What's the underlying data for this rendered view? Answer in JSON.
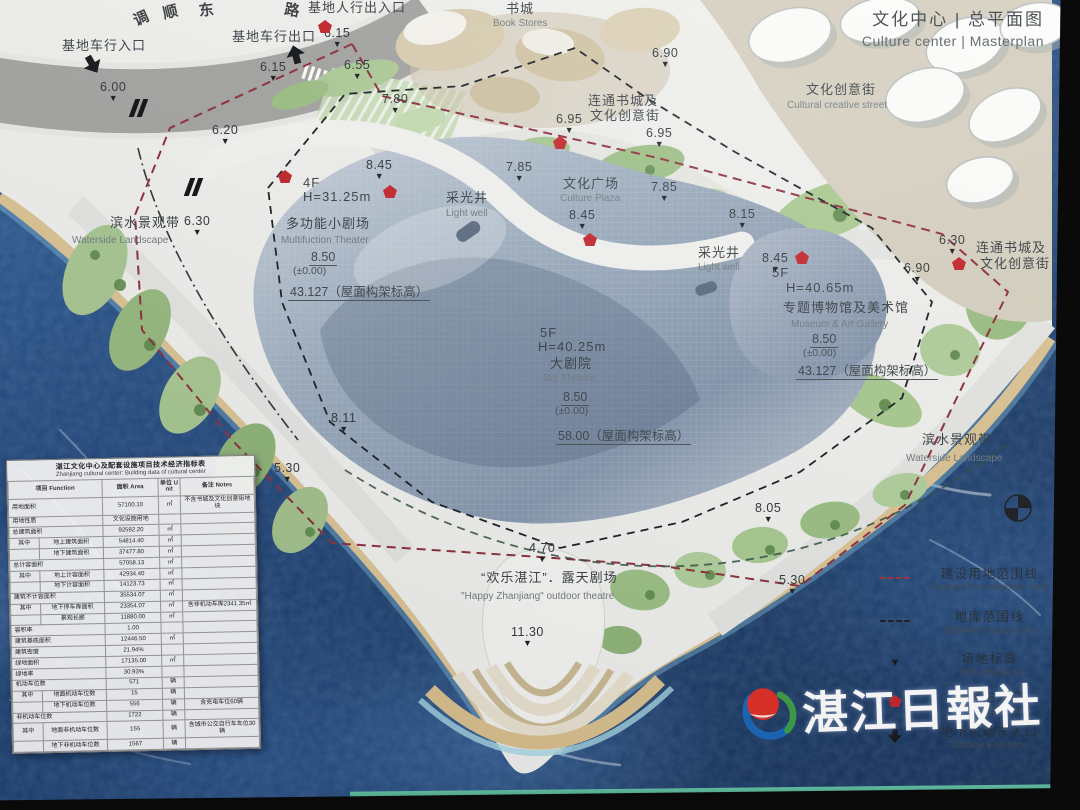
{
  "header": {
    "title_zh": "文化中心 | 总平面图",
    "title_en": "Culture center | Masterplan"
  },
  "logo": {
    "name": "湛江日報社"
  },
  "labels": [
    {
      "t": "调",
      "x": 131,
      "y": 14,
      "cls": "road",
      "rot": -24
    },
    {
      "t": "顺",
      "x": 161,
      "y": 6,
      "cls": "road",
      "rot": -14
    },
    {
      "t": "东",
      "x": 198,
      "y": 3,
      "cls": "road",
      "rot": -6
    },
    {
      "t": "路",
      "x": 286,
      "y": 1,
      "cls": "road",
      "rot": 10
    },
    {
      "t": "基地车行入口",
      "x": 62,
      "y": 39,
      "cls": "zh"
    },
    {
      "t": "基地车行出口",
      "x": 232,
      "y": 30,
      "cls": "zh"
    },
    {
      "t": "基地人行出入口",
      "x": 308,
      "y": 1,
      "cls": "zh"
    },
    {
      "t": "书城",
      "x": 506,
      "y": 2,
      "cls": "zh"
    },
    {
      "t": "Book Stores",
      "x": 493,
      "y": 18,
      "cls": "en"
    },
    {
      "t": "连通书城及",
      "x": 588,
      "y": 94,
      "cls": "zh"
    },
    {
      "t": "文化创意街",
      "x": 590,
      "y": 109,
      "cls": "zh"
    },
    {
      "t": "文化创意街",
      "x": 806,
      "y": 83,
      "cls": "zh"
    },
    {
      "t": "Cultural creative street",
      "x": 787,
      "y": 100,
      "cls": "en"
    },
    {
      "t": "滨水景观带",
      "x": 110,
      "y": 216,
      "cls": "zh"
    },
    {
      "t": "Waterside Landscape",
      "x": 72,
      "y": 235,
      "cls": "en"
    },
    {
      "t": "4F",
      "x": 303,
      "y": 176,
      "cls": "zh"
    },
    {
      "t": "H=31.25m",
      "x": 303,
      "y": 190,
      "cls": "zh"
    },
    {
      "t": "多功能小剧场",
      "x": 286,
      "y": 217,
      "cls": "zh"
    },
    {
      "t": "Multifuction Theater",
      "x": 281,
      "y": 235,
      "cls": "en"
    },
    {
      "t": "8.50",
      "x": 309,
      "y": 250,
      "cls": "val"
    },
    {
      "t": "(±0.00)",
      "x": 293,
      "y": 265,
      "cls": "zhs"
    },
    {
      "t": "43.127（屋面构架标高）",
      "x": 288,
      "y": 285,
      "cls": "val"
    },
    {
      "t": "采光井",
      "x": 446,
      "y": 191,
      "cls": "zh"
    },
    {
      "t": "Light well",
      "x": 446,
      "y": 208,
      "cls": "en"
    },
    {
      "t": "文化广场",
      "x": 563,
      "y": 177,
      "cls": "zh"
    },
    {
      "t": "Culture Plaza",
      "x": 560,
      "y": 193,
      "cls": "en"
    },
    {
      "t": "采光井",
      "x": 698,
      "y": 246,
      "cls": "zh"
    },
    {
      "t": "Light well",
      "x": 698,
      "y": 262,
      "cls": "en"
    },
    {
      "t": "5F",
      "x": 540,
      "y": 326,
      "cls": "zh"
    },
    {
      "t": "H=40.25m",
      "x": 538,
      "y": 340,
      "cls": "zh"
    },
    {
      "t": "大剧院",
      "x": 550,
      "y": 357,
      "cls": "zh"
    },
    {
      "t": "Big Theatre",
      "x": 544,
      "y": 373,
      "cls": "en"
    },
    {
      "t": "8.50",
      "x": 561,
      "y": 390,
      "cls": "val"
    },
    {
      "t": "(±0.00)",
      "x": 555,
      "y": 405,
      "cls": "zhs"
    },
    {
      "t": "58.00（屋面构架标高）",
      "x": 556,
      "y": 429,
      "cls": "val"
    },
    {
      "t": "5F",
      "x": 772,
      "y": 266,
      "cls": "zh"
    },
    {
      "t": "H=40.65m",
      "x": 786,
      "y": 281,
      "cls": "zh"
    },
    {
      "t": "专题博物馆及美术馆",
      "x": 783,
      "y": 301,
      "cls": "zh"
    },
    {
      "t": "Museum & Art Gallery",
      "x": 791,
      "y": 319,
      "cls": "en"
    },
    {
      "t": "8.50",
      "x": 810,
      "y": 332,
      "cls": "val"
    },
    {
      "t": "(±0.00)",
      "x": 803,
      "y": 347,
      "cls": "zhs"
    },
    {
      "t": "43.127（屋面构架标高）",
      "x": 796,
      "y": 364,
      "cls": "val"
    },
    {
      "t": "连通书城及",
      "x": 976,
      "y": 241,
      "cls": "zh"
    },
    {
      "t": "文化创意街",
      "x": 980,
      "y": 257,
      "cls": "zh"
    },
    {
      "t": "滨水景观带",
      "x": 922,
      "y": 433,
      "cls": "zh"
    },
    {
      "t": "Waterside Landscape",
      "x": 906,
      "y": 453,
      "cls": "en"
    },
    {
      "t": "“欢乐湛江”．露天剧场",
      "x": 481,
      "y": 571,
      "cls": "zh"
    },
    {
      "t": "\"Happy Zhanjiang\" outdoor theatre",
      "x": 461,
      "y": 591,
      "cls": "en"
    }
  ],
  "elevations": [
    {
      "x": 100,
      "y": 80,
      "v": "6.00"
    },
    {
      "x": 260,
      "y": 60,
      "v": "6.15"
    },
    {
      "x": 324,
      "y": 26,
      "v": "6.15"
    },
    {
      "x": 344,
      "y": 58,
      "v": "6.55"
    },
    {
      "x": 212,
      "y": 123,
      "v": "6.20"
    },
    {
      "x": 382,
      "y": 92,
      "v": "7.80"
    },
    {
      "x": 652,
      "y": 46,
      "v": "6.90"
    },
    {
      "x": 556,
      "y": 112,
      "v": "6.95"
    },
    {
      "x": 646,
      "y": 126,
      "v": "6.95"
    },
    {
      "x": 184,
      "y": 214,
      "v": "6.30"
    },
    {
      "x": 366,
      "y": 158,
      "v": "8.45"
    },
    {
      "x": 506,
      "y": 160,
      "v": "7.85"
    },
    {
      "x": 651,
      "y": 180,
      "v": "7.85"
    },
    {
      "x": 729,
      "y": 207,
      "v": "8.15"
    },
    {
      "x": 569,
      "y": 208,
      "v": "8.45"
    },
    {
      "x": 762,
      "y": 251,
      "v": "8.45"
    },
    {
      "x": 939,
      "y": 233,
      "v": "6.30"
    },
    {
      "x": 904,
      "y": 261,
      "v": "6.90"
    },
    {
      "x": 331,
      "y": 411,
      "v": "8.11"
    },
    {
      "x": 274,
      "y": 461,
      "v": "5.30"
    },
    {
      "x": 529,
      "y": 541,
      "v": "4.70"
    },
    {
      "x": 511,
      "y": 625,
      "v": "11.30"
    },
    {
      "x": 755,
      "y": 501,
      "v": "8.05"
    },
    {
      "x": 779,
      "y": 573,
      "v": "5.30"
    }
  ],
  "pentagons": [
    [
      318,
      20
    ],
    [
      553,
      136
    ],
    [
      278,
      170
    ],
    [
      383,
      185
    ],
    [
      583,
      233
    ],
    [
      795,
      251
    ],
    [
      952,
      257
    ]
  ],
  "arrows": [
    {
      "x": 83,
      "y": 55,
      "r": 150
    },
    {
      "x": 286,
      "y": 45,
      "r": -15
    }
  ],
  "garage_icons": [
    [
      131,
      99
    ],
    [
      186,
      178
    ]
  ],
  "table": {
    "title_zh": "湛江文化中心及配套设施项目技术经济指标表",
    "title_en": "Zhanjiang cultural center: Building data of cultural center",
    "headers": [
      "项目 Function",
      "面积 Area",
      "单位 Unit",
      "备注 Notes"
    ],
    "rows": [
      {
        "a": "用地面积",
        "b": "",
        "v": "57100.10",
        "u": "㎡",
        "n": "不含书城及文化创意街地块"
      },
      {
        "a": "用地性质",
        "b": "",
        "v": "文化设施用地",
        "u": "",
        "n": ""
      },
      {
        "a": "总建筑面积",
        "b": "",
        "v": "92592.20",
        "u": "㎡",
        "n": ""
      },
      {
        "a": "其中",
        "b": "地上建筑面积",
        "v": "54814.40",
        "u": "㎡",
        "n": ""
      },
      {
        "a": "",
        "b": "地下建筑面积",
        "v": "37477.80",
        "u": "㎡",
        "n": ""
      },
      {
        "a": "总计容面积",
        "b": "",
        "v": "57058.13",
        "u": "㎡",
        "n": ""
      },
      {
        "a": "其中",
        "b": "地上计容面积",
        "v": "42934.40",
        "u": "㎡",
        "n": ""
      },
      {
        "a": "",
        "b": "地下计容面积",
        "v": "14123.73",
        "u": "㎡",
        "n": ""
      },
      {
        "a": "建筑不计容面积",
        "b": "",
        "v": "35534.07",
        "u": "㎡",
        "n": ""
      },
      {
        "a": "其中",
        "b": "地下停车库面积",
        "v": "23354.07",
        "u": "㎡",
        "n": "含非机动车库2341.35㎡"
      },
      {
        "a": "",
        "b": "景观长廊",
        "v": "11880.00",
        "u": "㎡",
        "n": ""
      },
      {
        "a": "容积率",
        "b": "",
        "v": "1.00",
        "u": "",
        "n": ""
      },
      {
        "a": "建筑基底面积",
        "b": "",
        "v": "12446.50",
        "u": "㎡",
        "n": ""
      },
      {
        "a": "建筑密度",
        "b": "",
        "v": "21.94%",
        "u": "",
        "n": ""
      },
      {
        "a": "绿地面积",
        "b": "",
        "v": "17135.00",
        "u": "㎡",
        "n": ""
      },
      {
        "a": "绿地率",
        "b": "",
        "v": "30.93%",
        "u": "",
        "n": ""
      },
      {
        "a": "机动车位数",
        "b": "",
        "v": "571",
        "u": "辆",
        "n": ""
      },
      {
        "a": "其中",
        "b": "地面机动车位数",
        "v": "15",
        "u": "辆",
        "n": ""
      },
      {
        "a": "",
        "b": "地下机动车位数",
        "v": "556",
        "u": "辆",
        "n": "含充电车位60辆"
      },
      {
        "a": "非机动车位数",
        "b": "",
        "v": "1722",
        "u": "辆",
        "n": ""
      },
      {
        "a": "其中",
        "b": "地面非机动车位数",
        "v": "155",
        "u": "辆",
        "n": "含城市公交自行车车位30辆"
      },
      {
        "a": "",
        "b": "地下非机动车位数",
        "v": "1567",
        "u": "辆",
        "n": ""
      }
    ]
  },
  "legend": {
    "items": [
      {
        "top": 563,
        "sym": "redline",
        "zh": "建设用地范围线",
        "en": "Scope of construction land"
      },
      {
        "top": 606,
        "sym": "blackline",
        "zh": "地库范围线",
        "en": "Basement scope line"
      },
      {
        "top": 648,
        "sym": "tri",
        "zh": "场地标高",
        "en": "Site elevation"
      },
      {
        "top": 686,
        "sym": "pent",
        "zh": "建筑主入口",
        "en": "Building Entrance"
      },
      {
        "top": 721,
        "sym": "arrow",
        "zh": "地下机动车入口",
        "en": "Garage Entrance"
      }
    ]
  }
}
